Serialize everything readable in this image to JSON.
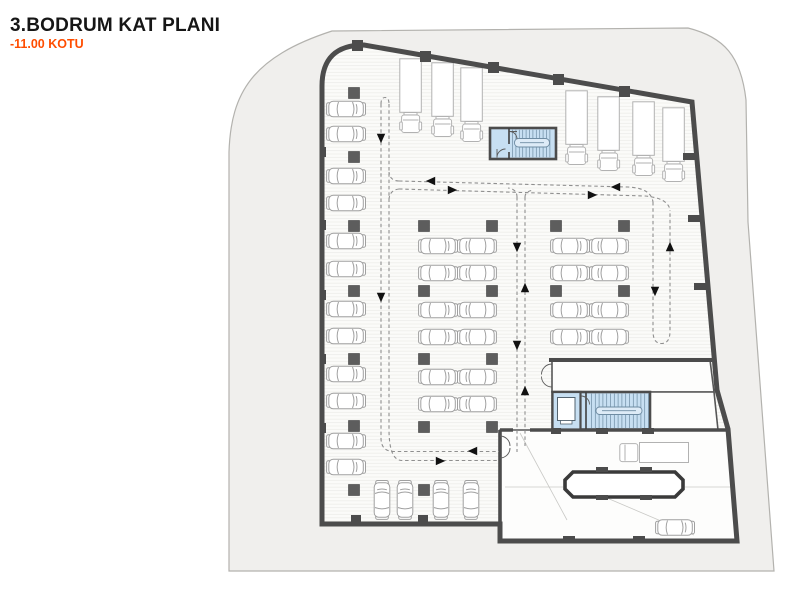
{
  "title": {
    "floor": "3.BODRUM KAT PLANI",
    "elevation": "-11.00 KOTU"
  },
  "colors": {
    "title_text": "#161616",
    "elevation_text": "#ff4d00",
    "site_fill": "#f0efed",
    "site_border": "#b3b2ae",
    "wall": "#4c4c4c",
    "floor_fill": "#fbfbf9",
    "floor_hatch": "#efefec",
    "room_fill": "#fdfdfc",
    "stair_core_fill": "#c7dff2",
    "stair_core_lines": "#6e8ca3",
    "car_outline": "#a0a0a0",
    "truck_outline": "#b2b2b2",
    "lane_dash": "#8f8f8f",
    "arrow": "#111111",
    "column": "#5d5d5d"
  }
}
